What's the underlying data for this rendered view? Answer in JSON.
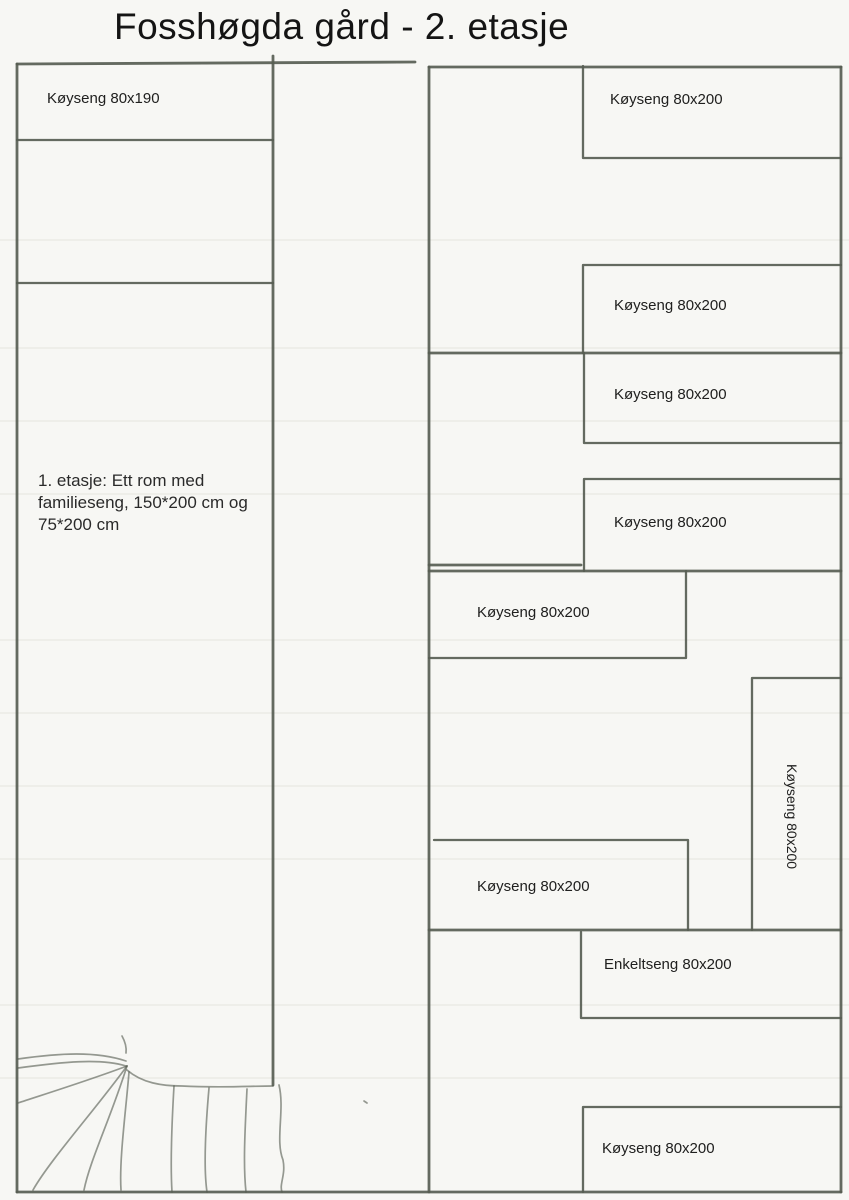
{
  "title": "Fosshøgda gård - 2. etasje",
  "left_wing": {
    "bed_label": "Køyseng 80x190",
    "note": "1. etasje: Ett rom med\nfamilieseng, 150*200 cm og\n75*200 cm"
  },
  "right_wing": {
    "beds": [
      {
        "id": "bed-1",
        "room": "top",
        "label": "Køyseng 80x200"
      },
      {
        "id": "bed-2",
        "room": "top",
        "label": "Køyseng 80x200"
      },
      {
        "id": "bed-3",
        "room": "second",
        "label": "Køyseng 80x200"
      },
      {
        "id": "bed-4",
        "room": "second",
        "label": "Køyseng 80x200"
      },
      {
        "id": "bed-5",
        "room": "third",
        "label": "Køyseng 80x200"
      },
      {
        "id": "bed-6",
        "room": "third",
        "label": "Køyseng 80x200",
        "orientation": "vertical"
      },
      {
        "id": "bed-7",
        "room": "third",
        "label": "Køyseng 80x200"
      },
      {
        "id": "bed-8",
        "room": "bottom",
        "label": "Enkeltseng 80x200"
      },
      {
        "id": "bed-9",
        "room": "bottom",
        "label": "Køyseng 80x200"
      }
    ]
  },
  "colors": {
    "paper": "#f7f7f4",
    "pencil": "#575d53",
    "text": "#1c1c1c",
    "ruling": "#e0dfd8"
  }
}
